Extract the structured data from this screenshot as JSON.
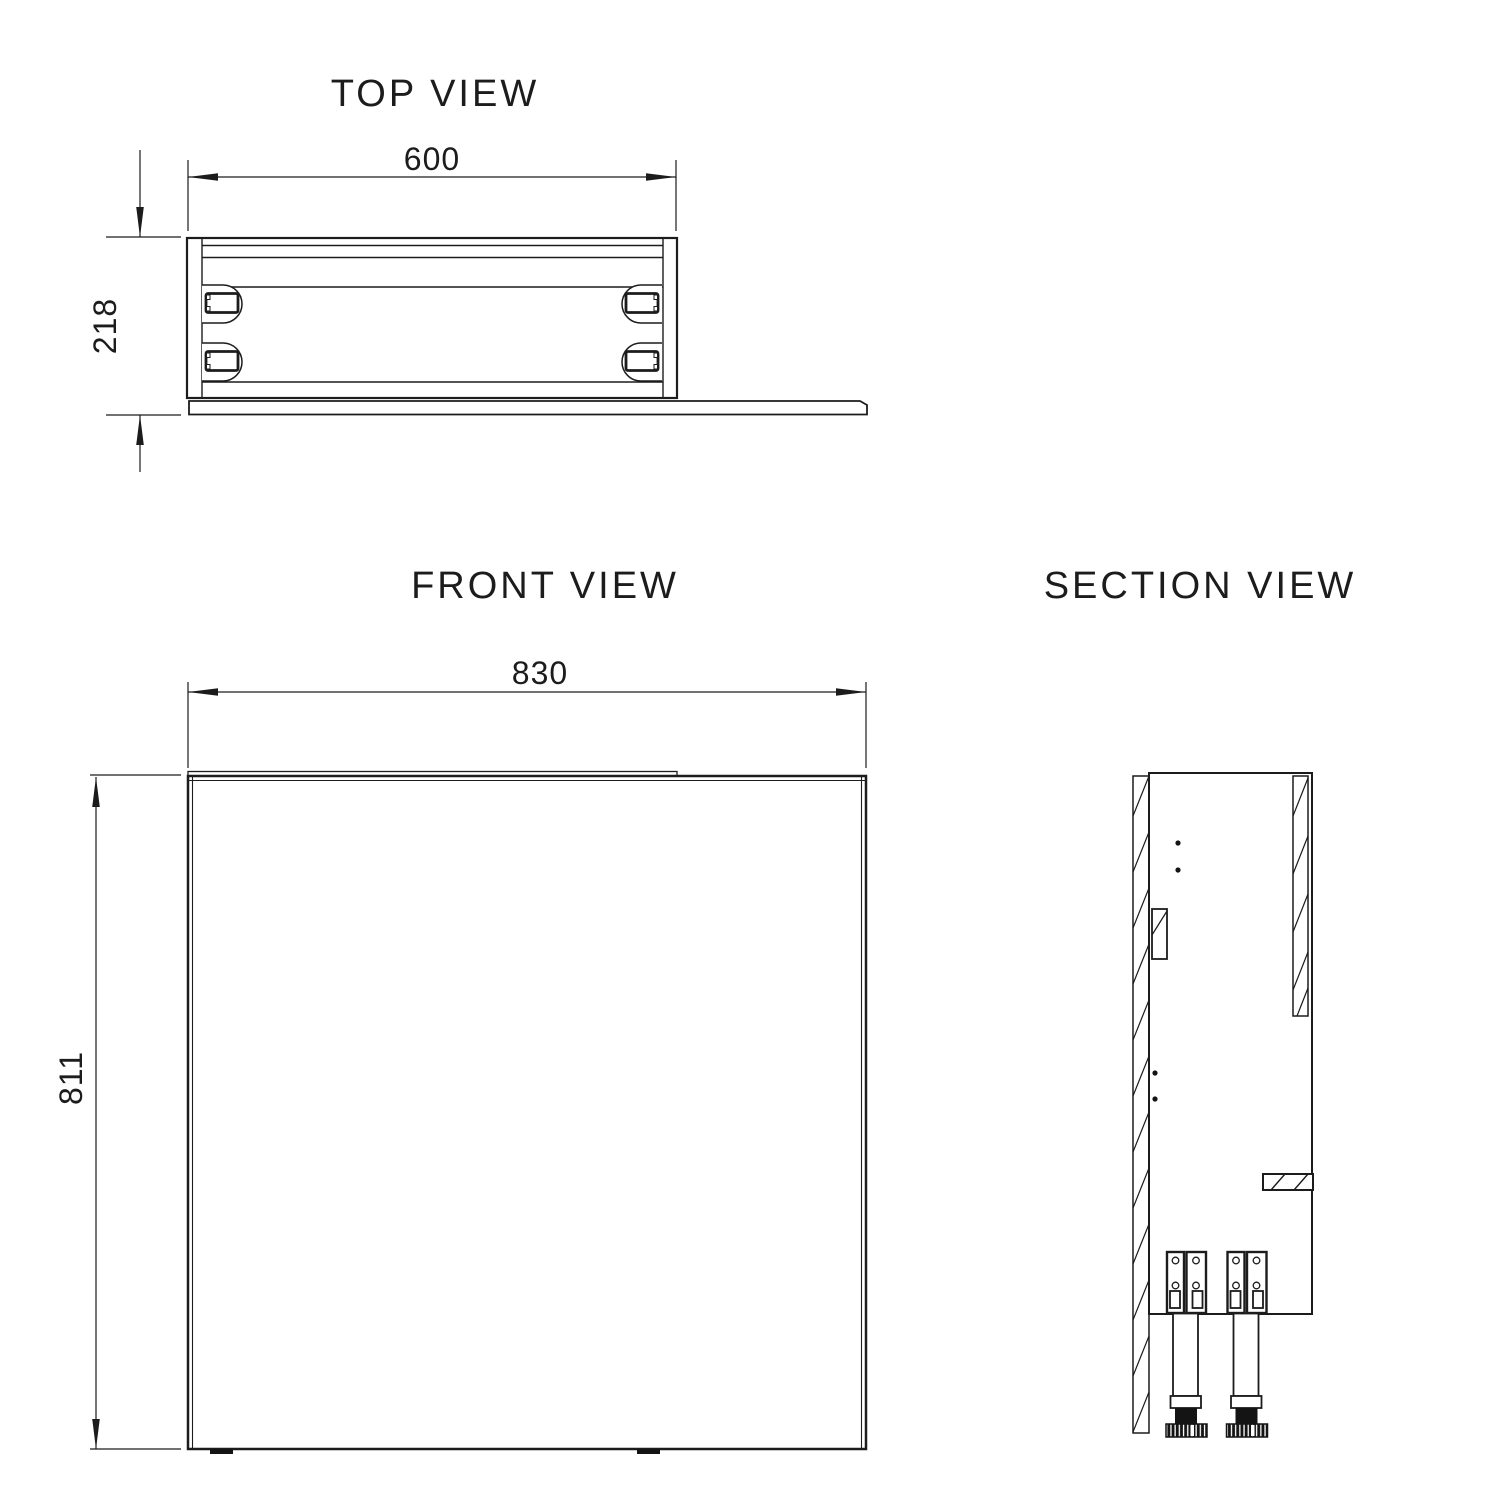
{
  "page": {
    "background": "#ffffff",
    "line_color": "#1c1c1c"
  },
  "views": {
    "top": {
      "title": "TOP VIEW",
      "dim_width": "600",
      "dim_depth": "218"
    },
    "front": {
      "title": "FRONT VIEW",
      "dim_width": "830",
      "dim_height": "811"
    },
    "section": {
      "title": "SECTION VIEW"
    }
  }
}
